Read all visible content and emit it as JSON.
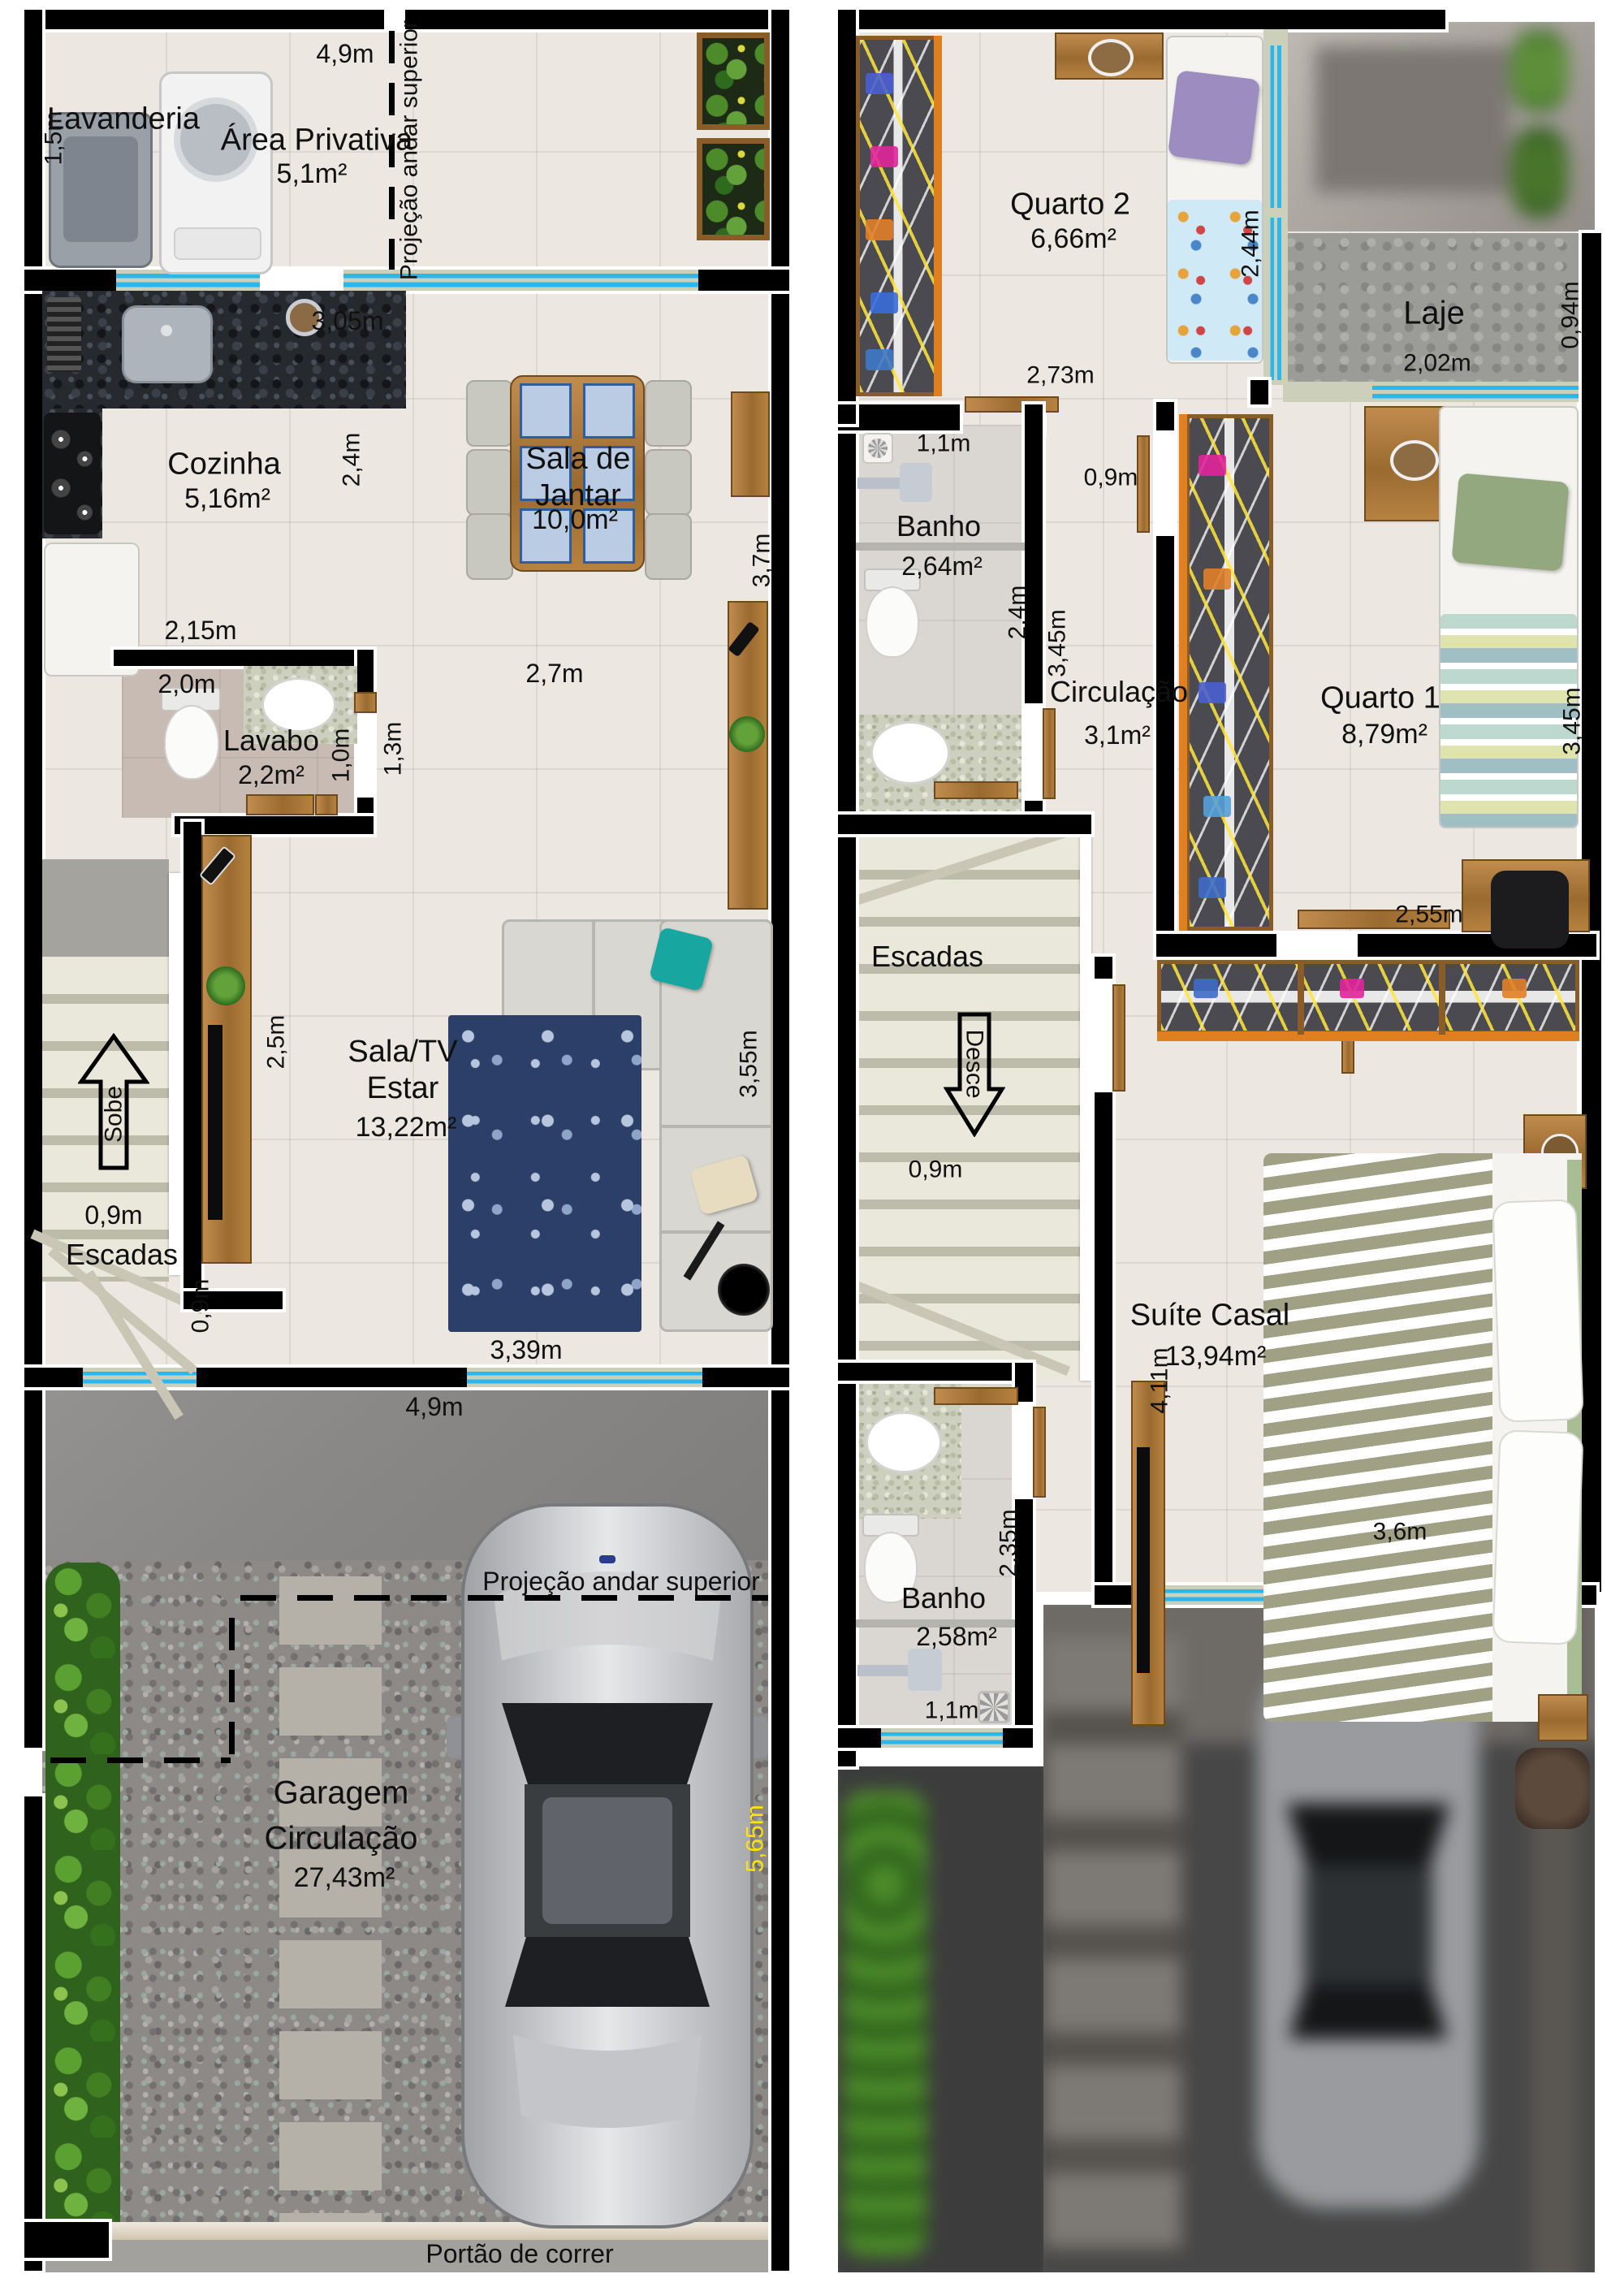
{
  "colors": {
    "window_accent": "#29b7ef",
    "garage_dim_yellow": "#ffe400",
    "wall": "#000000"
  },
  "ground_floor": {
    "rooms": {
      "lavanderia": {
        "name": "Lavanderia"
      },
      "area_privativa": {
        "name": "Área Privativa",
        "area": "5,1m²"
      },
      "cozinha": {
        "name": "Cozinha",
        "area": "5,16m²"
      },
      "sala_jantar": {
        "name": "Sala de\nJantar",
        "area": "10,0m²"
      },
      "lavabo": {
        "name": "Lavabo",
        "area": "2,2m²"
      },
      "sala_tv": {
        "name": "Sala/TV\nEstar",
        "area": "13,22m²"
      },
      "escadas": {
        "name": "Escadas",
        "direction": "Sobe"
      },
      "garagem": {
        "name": "Garagem",
        "name2": "Circulação",
        "area": "27,43m²"
      }
    },
    "annotations": {
      "projecao_vertical": "Projeção andar superior",
      "projecao_garagem": "Projeção andar superior",
      "portao": "Portão de correr"
    },
    "dimensions": {
      "lavanderia_h": "1,5m",
      "frente_top": "4,9m",
      "cozinha_w": "3,05m",
      "cozinha_h": "2,4m",
      "jantar_h": "3,7m",
      "cozinha_b": "2,15m",
      "lavabo_w": "2,0m",
      "lavabo_h": "1,0m",
      "hall_h": "1,3m",
      "sala_w": "2,7m",
      "tv_wall": "2,5m",
      "sala_h": "3,55m",
      "escada_w": "0,9m",
      "escada_saida": "0,9m",
      "sala_b": "3,39m",
      "frente_b": "4,9m",
      "garagem_d": "5,65m"
    }
  },
  "upper_floor": {
    "rooms": {
      "quarto2": {
        "name": "Quarto 2",
        "area": "6,66m²"
      },
      "laje": {
        "name": "Laje"
      },
      "banho_sup": {
        "name": "Banho",
        "area": "2,64m²"
      },
      "circulacao": {
        "name": "Circulação",
        "area": "3,1m²"
      },
      "quarto1": {
        "name": "Quarto 1",
        "area": "8,79m²"
      },
      "escadas": {
        "name": "Escadas",
        "direction": "Desce"
      },
      "suite": {
        "name": "Suíte Casal",
        "area": "13,94m²"
      },
      "banho_suite": {
        "name": "Banho",
        "area": "2,58m²"
      }
    },
    "dimensions": {
      "quarto2_h": "2,44m",
      "quarto2_w": "2,73m",
      "laje_w": "2,02m",
      "laje_h": "0,94m",
      "banho_sup_w": "1,1m",
      "banho_sup_h": "2,4m",
      "circ_top": "0,9m",
      "circ_h": "3,45m",
      "quarto1_h": "3,45m",
      "suite_top": "2,55m",
      "escada_w": "0,9m",
      "suite_h": "4,11m",
      "suite_w": "3,6m",
      "banho_suite_h": "2,35m",
      "banho_suite_w": "1,1m"
    }
  }
}
